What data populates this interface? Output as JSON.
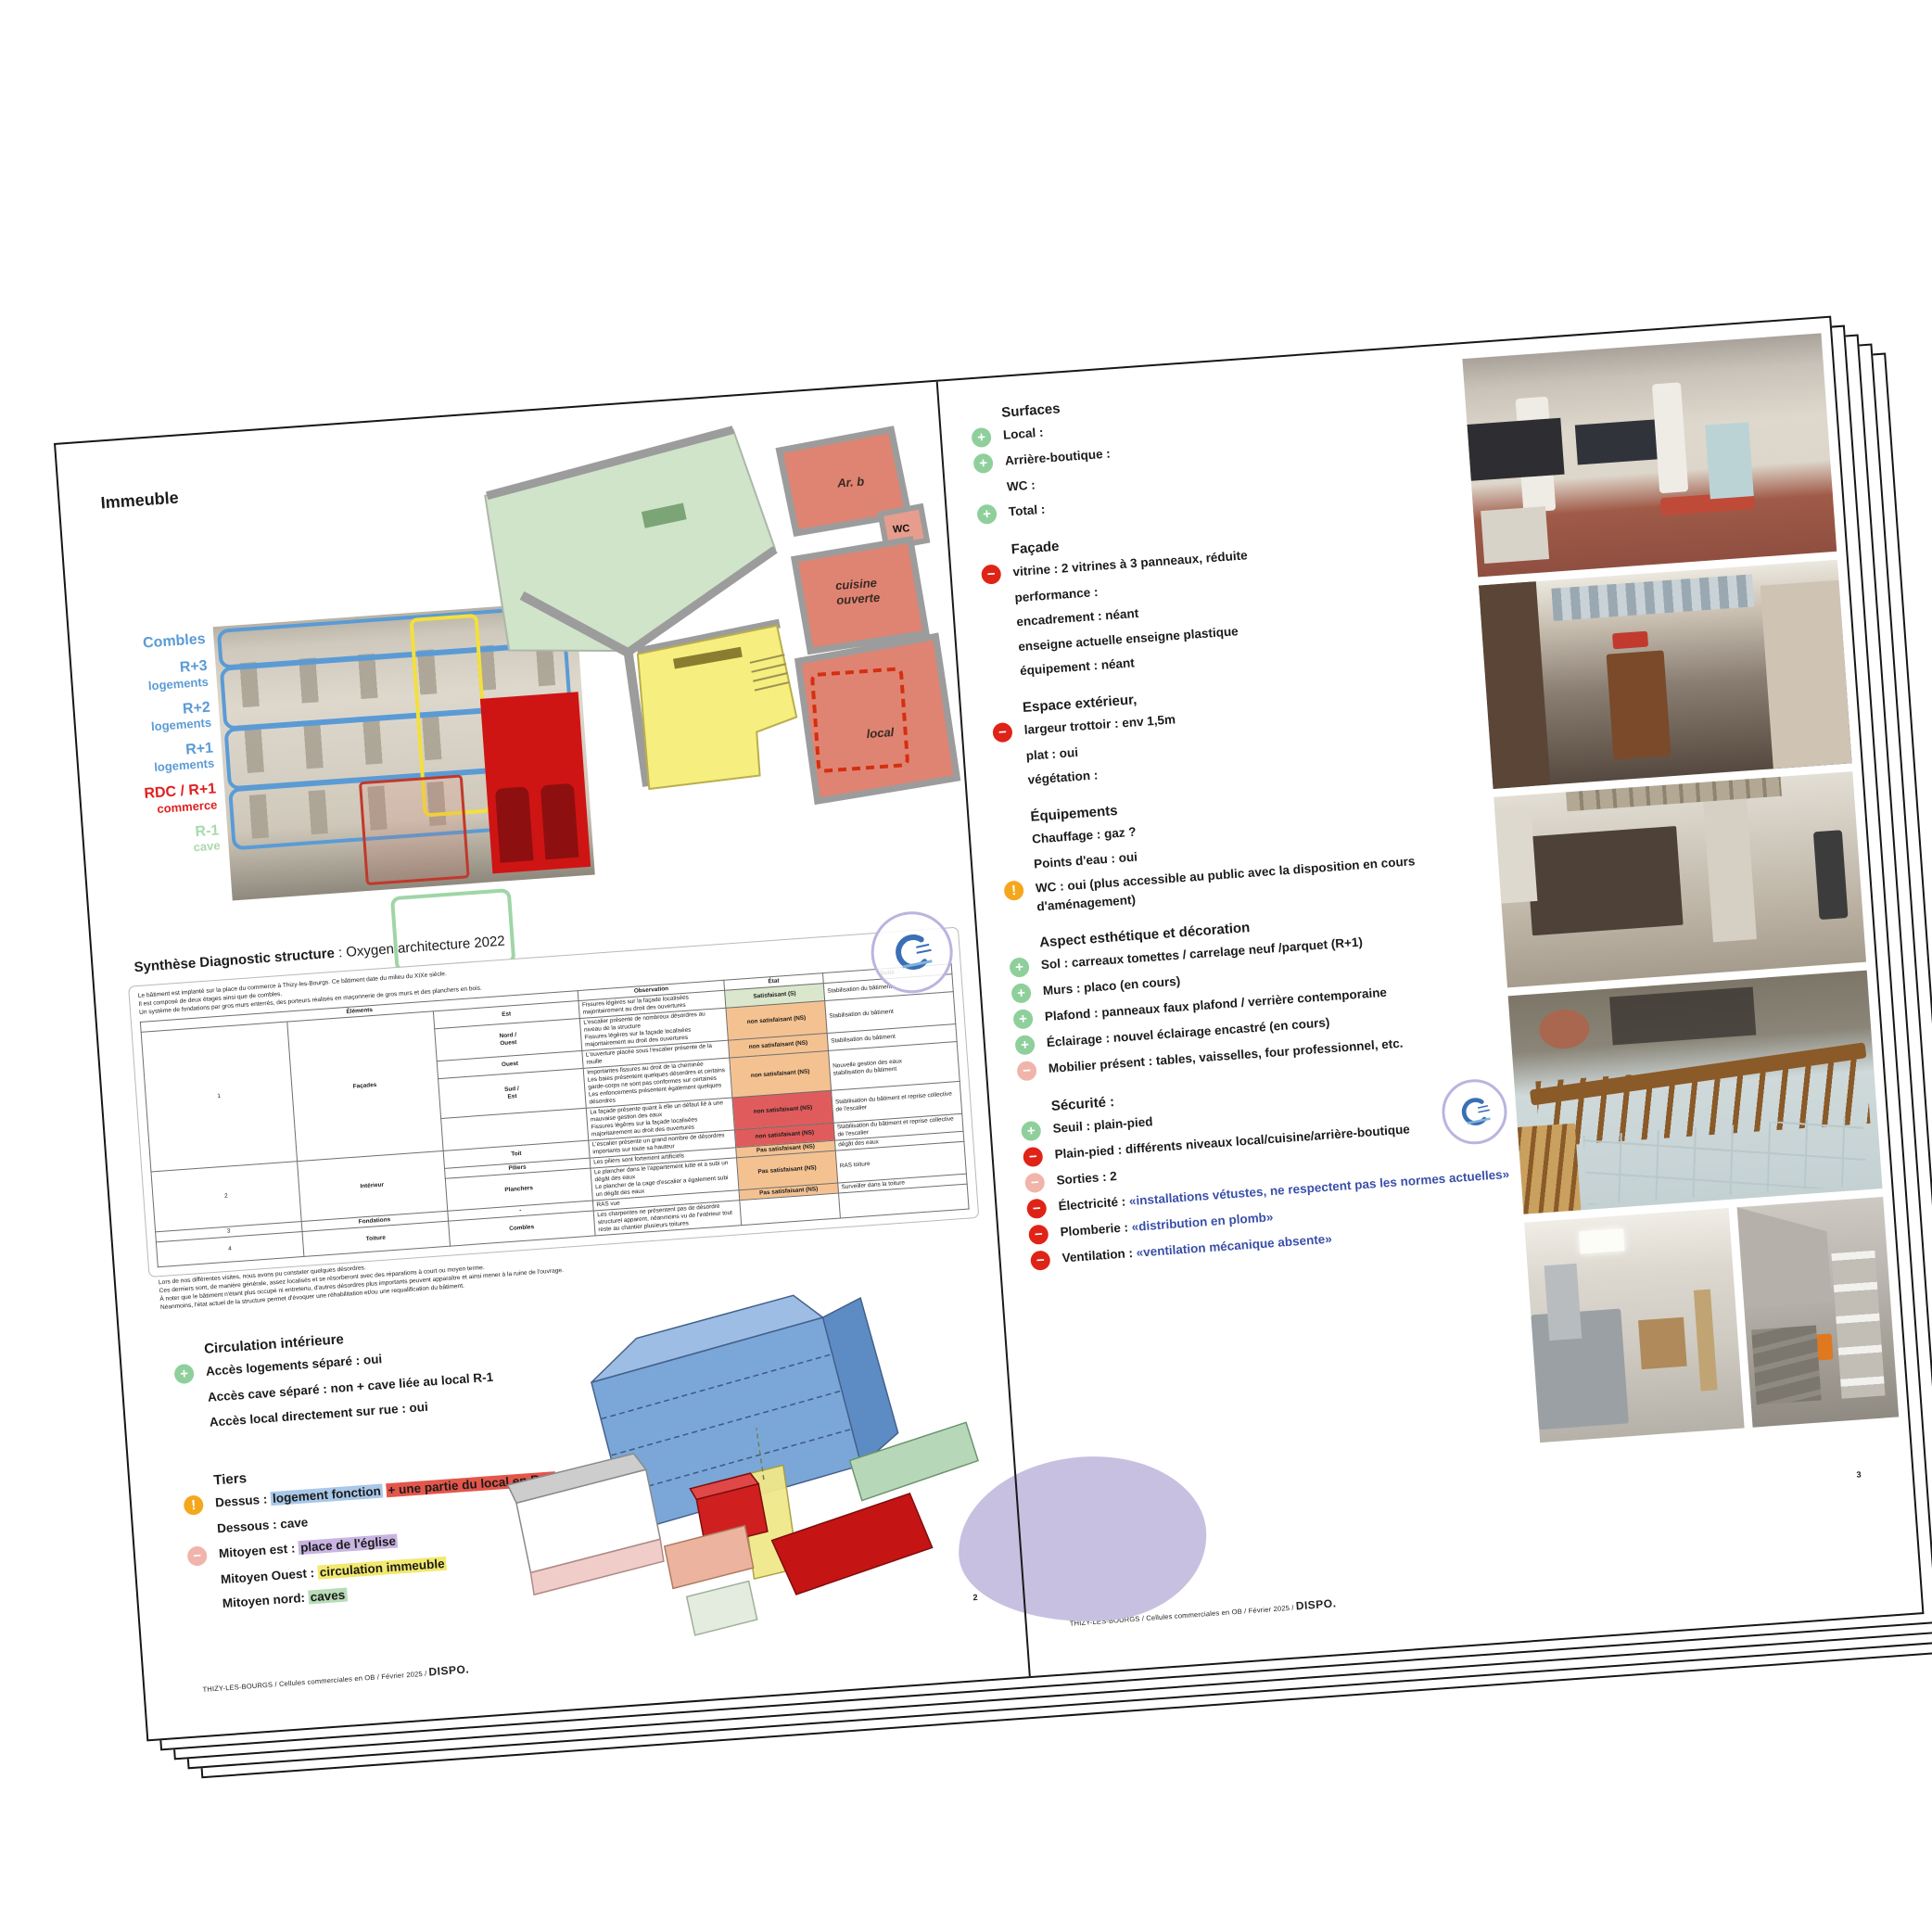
{
  "icons": {
    "plus": {
      "glyph": "+",
      "color": "#8fcf9b",
      "name": "plus-icon"
    },
    "minus_red": {
      "glyph": "−",
      "color": "#e02317",
      "name": "minus-red-icon"
    },
    "minus_pink": {
      "glyph": "−",
      "color": "#f0b4ab",
      "name": "minus-pink-icon"
    },
    "warn": {
      "glyph": "!",
      "color": "#f5a71c",
      "name": "warning-icon"
    }
  },
  "meta": {
    "footer_text": "THIZY-LES-BOURGS / Cellules commerciales en OB / Février 2025 / ",
    "brand": "DISPO.",
    "page_number_left": "2",
    "page_number_right": "3"
  },
  "left_page": {
    "title": "Immeuble",
    "facade": {
      "labels": [
        {
          "lines": [
            "Combles"
          ],
          "color": "blue"
        },
        {
          "lines": [
            "R+3",
            "logements"
          ],
          "color": "blue"
        },
        {
          "lines": [
            "R+2",
            "logements"
          ],
          "color": "blue"
        },
        {
          "lines": [
            "R+1",
            "logements"
          ],
          "color": "blue"
        },
        {
          "lines": [
            "RDC / R+1",
            "commerce"
          ],
          "color": "red"
        },
        {
          "lines": [
            "R-1",
            "cave"
          ],
          "color": "green"
        }
      ]
    },
    "plan": {
      "labels": {
        "arb": "Ar. b",
        "wc": "WC",
        "cuisine1": "cuisine",
        "cuisine2": "ouverte",
        "local": "local"
      }
    },
    "diag_title_bold": "Synthèse Diagnostic structure",
    "diag_title_rest": " : Oxygen architecture 2022",
    "intro_lines": [
      "Le bâtiment est implanté sur la place du commerce à Thizy-les-Bourgs. Ce bâtiment date du milieu du XIXe siècle.",
      "Il est composé de deux étages ainsi que de combles.",
      "Un système de fondations par gros murs enterrés, des porteurs réalisés en maçonnerie de gros murs et des planchers en bois."
    ],
    "table": {
      "headers": {
        "elements": "Éléments",
        "observation": "Observation",
        "etat": "État",
        "suite": "Suite"
      },
      "rows": [
        {
          "n": "1",
          "group": "Façades",
          "span": 5,
          "sub": "Est",
          "obs": "Fissures légères sur la façade localisées majoritairement au droit des ouvertures",
          "etat": "Satisfaisant (S)",
          "color": "green",
          "suite": "Stabilisation du bâtiment"
        },
        {
          "sub": "Nord /\nOuest",
          "obs": "L'escalier présente de nombreux désordres au niveau de la structure\nFissures légères sur la façade localisées majoritairement au droit des ouvertures",
          "etat": "non satisfaisant (NS)",
          "color": "orange",
          "suite": "Stabilisation du bâtiment"
        },
        {
          "sub": "Ouest",
          "obs": "L'ouverture placée sous l'escalier présente de la rouille",
          "etat": "non satisfaisant (NS)",
          "color": "orange",
          "suite": "Stabilisation du bâtiment"
        },
        {
          "sub": "Sud /\nEst",
          "obs": "Importantes fissures au droit de la cheminée\nLes baies présentent quelques désordres et certains garde-corps ne sont pas conformes sur certaines\nLes enfoncements présentent également quelques désordres",
          "etat": "non satisfaisant (NS)",
          "color": "orange",
          "suite": "Nouvelle gestion des eaux\nstabilisation du bâtiment"
        },
        {
          "sub": "",
          "obs": "La façade présente quant à elle un défaut lié à une mauvaise gestion des eaux\nFissures légères sur la façade localisées majoritairement au droit des ouvertures",
          "etat": "non satisfaisant (NS)",
          "color": "red",
          "suite": "Stabilisation du bâtiment et reprise collective de l'escalier"
        },
        {
          "n": "2",
          "group": "Intérieur",
          "span": 3,
          "sub": "Toit",
          "obs": "L'escalier présente un grand nombre de désordres importants sur toute sa hauteur",
          "etat": "non satisfaisant (NS)",
          "color": "red",
          "suite": "Stabilisation du bâtiment et reprise collective de l'escalier"
        },
        {
          "sub": "Piliers",
          "obs": "Les piliers sont fortement artificiels",
          "etat": "Pas satisfaisant (NS)",
          "color": "orange",
          "suite": "dégât des eaux"
        },
        {
          "sub": "Planchers",
          "obs": "Le plancher dans le l'appartement lutte et a subi un dégât des eaux\nLe plancher de la cage d'escalier a également subi un dégât des eaux",
          "etat": "Pas satisfaisant (NS)",
          "color": "orange",
          "suite": "RAS toiture"
        },
        {
          "n": "3",
          "group": "Fondations",
          "span": 1,
          "sub": "-",
          "obs": "RAS vue",
          "etat": "Pas satisfaisant (NS)",
          "color": "orange",
          "suite": "Surveiller dans la toiture"
        },
        {
          "n": "4",
          "group": "Toiture",
          "span": 1,
          "sub": "Combles",
          "obs": "Les charpentes ne présentent pas de désordre structurel apparent, néanmoins vu de l'intérieur tout reste au chantier plusieurs toitures",
          "etat": "",
          "color": "",
          "suite": ""
        }
      ]
    },
    "note_lines": [
      "Lors de nos différentes visites, nous avons pu constater quelques désordres.",
      "Ces derniers sont, de manière générale, assez localisés et se résorberont avec des réparations à court ou moyen terme.",
      "À noter que le bâtiment n'étant plus occupé ni entretenu, d'autres désordres plus importants peuvent apparaître et ainsi mener à la ruine de l'ouvrage.",
      "Néanmoins, l'état actuel de la structure permet d'évoquer une réhabilitation et/ou une requalification du bâtiment."
    ],
    "circulation": {
      "title": "Circulation intérieure",
      "items": [
        {
          "icon": "plus",
          "parts": [
            {
              "t": "Accès logements séparé : oui"
            }
          ]
        },
        {
          "parts": [
            {
              "t": "Accès cave séparé : non + cave liée au local R-1"
            }
          ]
        },
        {
          "parts": [
            {
              "t": "Accès local directement sur rue : oui"
            }
          ]
        }
      ]
    },
    "tiers": {
      "title": "Tiers",
      "items": [
        {
          "icon": "warn",
          "parts": [
            {
              "t": "Dessus : "
            },
            {
              "t": "logement fonction",
              "s": "hl-blue"
            },
            {
              "t": " "
            },
            {
              "t": "+ une partie du local en R+1",
              "s": "hl-red"
            }
          ]
        },
        {
          "parts": [
            {
              "t": "Dessous : cave"
            }
          ]
        },
        {
          "icon": "minus_pink",
          "parts": [
            {
              "t": "Mitoyen est : "
            },
            {
              "t": "place de l'église",
              "s": "hl-purple"
            }
          ]
        },
        {
          "parts": [
            {
              "t": "Mitoyen Ouest : "
            },
            {
              "t": "circulation immeuble",
              "s": "hl-yellow"
            }
          ]
        },
        {
          "parts": [
            {
              "t": "Mitoyen nord: "
            },
            {
              "t": "caves",
              "s": "hl-green"
            }
          ]
        }
      ]
    }
  },
  "right_page": {
    "sections": [
      {
        "id": "surfaces",
        "title": "Surfaces",
        "items": [
          {
            "icon": "plus",
            "parts": [
              {
                "t": "Local :"
              }
            ]
          },
          {
            "icon": "plus",
            "parts": [
              {
                "t": "Arrière-boutique :"
              }
            ]
          },
          {
            "parts": [
              {
                "t": "WC :"
              }
            ]
          },
          {
            "icon": "plus",
            "parts": [
              {
                "t": "Total :"
              }
            ]
          }
        ]
      },
      {
        "id": "facade",
        "title": "Façade",
        "items": [
          {
            "icon": "minus_red",
            "parts": [
              {
                "t": "vitrine : 2 vitrines à 3 panneaux, réduite"
              }
            ]
          },
          {
            "parts": [
              {
                "t": "performance :"
              }
            ]
          },
          {
            "parts": [
              {
                "t": "encadrement : néant"
              }
            ]
          },
          {
            "parts": [
              {
                "t": "enseigne actuelle  enseigne plastique"
              }
            ]
          },
          {
            "parts": [
              {
                "t": "équipement : néant"
              }
            ]
          }
        ]
      },
      {
        "id": "espace-exterieur",
        "title": "Espace extérieur,",
        "items": [
          {
            "icon": "minus_red",
            "parts": [
              {
                "t": "largeur trottoir : env 1,5m"
              }
            ]
          },
          {
            "parts": [
              {
                "t": "plat : oui"
              }
            ]
          },
          {
            "parts": [
              {
                "t": "végétation :"
              }
            ]
          }
        ]
      },
      {
        "id": "equipements",
        "title": "Équipements",
        "items": [
          {
            "parts": [
              {
                "t": "Chauffage : gaz ?"
              }
            ]
          },
          {
            "parts": [
              {
                "t": "Points d'eau : oui"
              }
            ]
          },
          {
            "icon": "warn",
            "parts": [
              {
                "t": "WC : oui (plus accessible au public avec la disposition en cours d'aménagement)"
              }
            ]
          }
        ]
      },
      {
        "id": "aspect",
        "title": "Aspect esthétique et décoration",
        "items": [
          {
            "icon": "plus",
            "parts": [
              {
                "t": "Sol : carreaux tomettes / carrelage neuf /parquet (R+1)"
              }
            ]
          },
          {
            "icon": "plus",
            "parts": [
              {
                "t": "Murs : placo (en cours)"
              }
            ]
          },
          {
            "icon": "plus",
            "parts": [
              {
                "t": "Plafond : panneaux faux plafond / verrière contemporaine"
              }
            ]
          },
          {
            "icon": "plus",
            "parts": [
              {
                "t": "Éclairage : nouvel éclairage encastré (en cours)"
              }
            ]
          },
          {
            "icon": "minus_pink",
            "parts": [
              {
                "t": "Mobilier présent : tables, vaisselles, four professionnel, etc."
              }
            ]
          }
        ]
      },
      {
        "id": "securite",
        "title": "Sécurité :",
        "items": [
          {
            "icon": "plus",
            "parts": [
              {
                "t": "Seuil : plain-pied"
              }
            ]
          },
          {
            "icon": "minus_red",
            "parts": [
              {
                "t": "Plain-pied : différents niveaux local/cuisine/arrière-boutique"
              }
            ]
          },
          {
            "icon": "minus_pink",
            "parts": [
              {
                "t": "Sorties : 2"
              }
            ]
          },
          {
            "icon": "minus_red",
            "parts": [
              {
                "t": "Électricité : "
              },
              {
                "t": "«installations vétustes, ne respectent pas les normes actuelles»",
                "s": "txt-blue"
              }
            ]
          },
          {
            "icon": "minus_red",
            "parts": [
              {
                "t": "Plomberie : "
              },
              {
                "t": "«distribution en plomb»",
                "s": "txt-blue"
              }
            ]
          },
          {
            "icon": "minus_red",
            "parts": [
              {
                "t": "Ventilation : "
              },
              {
                "t": "«ventilation mécanique absente»",
                "s": "txt-blue"
              }
            ]
          }
        ]
      }
    ],
    "photos": [
      "photo-local-columns",
      "photo-backroom-clutter",
      "photo-dark-panel-room",
      "photo-railing-glass-floor",
      "photo-kitchen-inox",
      "photo-cellar-shelves"
    ]
  }
}
